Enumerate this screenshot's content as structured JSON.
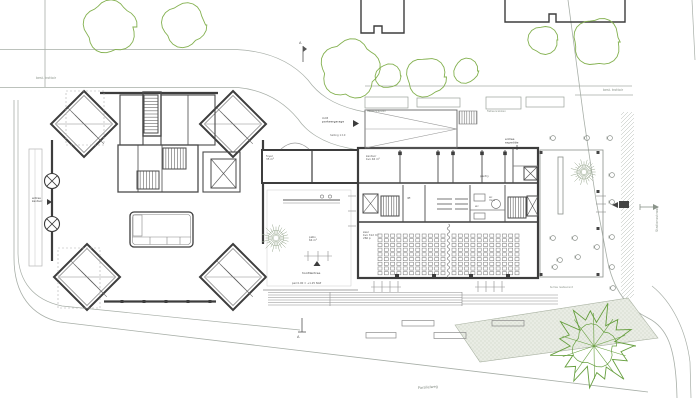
{
  "drawing": {
    "type": "architectural-site-plan-ground-floor",
    "colors": {
      "wall": "#3d3d3d",
      "wall_medium": "#5a5a5a",
      "fine": "#8c8c8c",
      "site_line": "#a7aea7",
      "tree_green": "#84b150",
      "tree_green_dark": "#669f3e",
      "bed_fill": "#e9ece4",
      "bed_dot": "#b9c3b0",
      "seat": "#7d7d7d",
      "label_dark": "#3c3c3c",
      "label_gray": "#8a938a"
    },
    "labels": [
      {
        "id": "note-nw",
        "t": "best. trottoir",
        "x": 36,
        "y": 79,
        "s": 3.2,
        "c": "#8a938a"
      },
      {
        "id": "note-ne",
        "t": "best. trottoir",
        "x": 603,
        "y": 91,
        "s": 3.2,
        "c": "#8a938a"
      },
      {
        "id": "street-east",
        "t": "Stationsstraat",
        "x": 658,
        "y": 232,
        "s": 3.5,
        "c": "#8a938a",
        "rot": -90
      },
      {
        "id": "street-south",
        "t": "Parallelweg",
        "x": 418,
        "y": 389,
        "s": 3.5,
        "c": "#7d867d",
        "rot": -4
      },
      {
        "id": "ramp-entry",
        "t": "inrit\nparkeergarage",
        "x": 322,
        "y": 119,
        "s": 3,
        "c": "#3c3c3c"
      },
      {
        "id": "ramp-slope",
        "t": "helling 1:10",
        "x": 330,
        "y": 136,
        "s": 2.6,
        "c": "#666666"
      },
      {
        "id": "bike-1",
        "t": "fietsenrekken",
        "x": 367,
        "y": 112,
        "s": 2.8,
        "c": "#8a938a"
      },
      {
        "id": "bike-2",
        "t": "fietsenrekken",
        "x": 487,
        "y": 112,
        "s": 2.8,
        "c": "#8a938a"
      },
      {
        "id": "entry-ne",
        "t": "entree\nexpeditie",
        "x": 505,
        "y": 140,
        "s": 2.9,
        "c": "#3c3c3c"
      },
      {
        "id": "room-a",
        "t": "kantoor\nbvo 46 m²",
        "x": 366,
        "y": 157,
        "s": 2.7,
        "c": "#555555"
      },
      {
        "id": "room-b",
        "t": "pantry",
        "x": 480,
        "y": 177,
        "s": 2.7,
        "c": "#555555"
      },
      {
        "id": "room-c",
        "t": "lift",
        "x": 407,
        "y": 199,
        "s": 2.7,
        "c": "#555555"
      },
      {
        "id": "room-d",
        "t": "wc",
        "x": 475,
        "y": 207,
        "s": 2.7,
        "c": "#555555"
      },
      {
        "id": "room-e",
        "t": "wc\nmiva",
        "x": 489,
        "y": 198,
        "s": 2.5,
        "c": "#555555"
      },
      {
        "id": "zaal",
        "t": "zaal\nbvo 312 m²\n260 p",
        "x": 363,
        "y": 233,
        "s": 2.7,
        "c": "#555555"
      },
      {
        "id": "patio",
        "t": "patio\n64 m²",
        "x": 309,
        "y": 238,
        "s": 2.7,
        "c": "#555555"
      },
      {
        "id": "hoofdentree",
        "t": "hoofdentree",
        "x": 302,
        "y": 274,
        "s": 3,
        "c": "#3c3c3c"
      },
      {
        "id": "peil",
        "t": "peil 0.00 = +1.25 NAP",
        "x": 292,
        "y": 284,
        "s": 2.6,
        "c": "#555555"
      },
      {
        "id": "west-entry",
        "t": "entree\nkantoor",
        "x": 32,
        "y": 199,
        "s": 2.7,
        "c": "#3c3c3c"
      },
      {
        "id": "link-room",
        "t": "foyer\n35 m²",
        "x": 266,
        "y": 157,
        "s": 2.7,
        "c": "#555555"
      },
      {
        "id": "terras",
        "t": "terras restaurant",
        "x": 550,
        "y": 288,
        "s": 2.7,
        "c": "#8a938a"
      },
      {
        "id": "marker-top",
        "t": "A",
        "x": 299,
        "y": 44,
        "s": 3.6,
        "c": "#555555"
      },
      {
        "id": "marker-bottom",
        "t": "A",
        "x": 297,
        "y": 338,
        "s": 3.6,
        "c": "#555555"
      }
    ],
    "trees": {
      "outline": [
        [
          110,
          27,
          25
        ],
        [
          184,
          25,
          21
        ],
        [
          350,
          69,
          28
        ],
        [
          388,
          76,
          12
        ],
        [
          426,
          77,
          19
        ],
        [
          466,
          71,
          12
        ],
        [
          543,
          40,
          14
        ],
        [
          597,
          42,
          23
        ]
      ],
      "hatched": [
        [
          276,
          238,
          14
        ],
        [
          584,
          172,
          13
        ]
      ],
      "big": [
        594,
        346,
        44
      ]
    },
    "chairs": [
      [
        553,
        138
      ],
      [
        587,
        138
      ],
      [
        610,
        138
      ],
      [
        612,
        175
      ],
      [
        612,
        202
      ],
      [
        612,
        237
      ],
      [
        612,
        267
      ],
      [
        613,
        288
      ],
      [
        553,
        238
      ],
      [
        575,
        238
      ],
      [
        560,
        260
      ],
      [
        578,
        257
      ],
      [
        555,
        267
      ],
      [
        597,
        247
      ]
    ],
    "benches": [
      [
        402,
        320.5,
        32,
        5.5
      ],
      [
        492,
        320.5,
        32,
        5.5
      ],
      [
        366,
        332.5,
        30,
        5.5
      ],
      [
        434,
        332.5,
        32,
        6
      ]
    ],
    "planters": [
      [
        365,
        97,
        43,
        11
      ],
      [
        417,
        98,
        43,
        9
      ],
      [
        486,
        97,
        35,
        12
      ],
      [
        526,
        97,
        38,
        10
      ]
    ],
    "columns": {
      "top": [
        [
          400,
          151.5
        ],
        [
          438,
          151.5
        ],
        [
          453,
          151.5
        ],
        [
          482,
          151.5
        ],
        [
          505,
          151.5
        ]
      ],
      "bottom": [
        [
          397,
          274
        ],
        [
          434,
          274
        ],
        [
          471,
          274
        ],
        [
          508,
          274
        ]
      ],
      "terrace": [
        [
          541,
          151
        ],
        [
          598,
          151
        ],
        [
          541,
          273
        ],
        [
          598,
          273
        ],
        [
          598,
          190
        ],
        [
          598,
          227
        ]
      ]
    },
    "tower_ticks": [
      [
        122,
        300
      ],
      [
        144,
        300
      ],
      [
        166,
        300
      ],
      [
        188,
        300
      ],
      [
        210,
        300
      ]
    ],
    "auditorium": {
      "rows": 9,
      "cols": 11,
      "px": 6.3,
      "py": 4.7,
      "y0": 234,
      "blocks": [
        378,
        452
      ],
      "w": 4,
      "h": 3.2,
      "divider_x": 448.5
    },
    "stairs": [
      [
        144,
        95,
        14,
        38,
        12,
        "h"
      ],
      [
        163,
        148,
        23,
        21,
        8,
        "v"
      ],
      [
        137,
        171,
        22,
        18,
        7,
        "v"
      ],
      [
        381,
        196,
        18,
        20,
        7,
        "v"
      ],
      [
        508,
        197,
        18,
        21,
        7,
        "v"
      ]
    ],
    "elevators": [
      [
        363,
        194,
        15,
        19
      ],
      [
        527,
        196,
        11,
        20
      ],
      [
        524,
        167,
        13,
        13
      ],
      [
        211,
        159,
        25,
        29
      ]
    ],
    "door_circles": [
      [
        52,
        181,
        7.5
      ],
      [
        52,
        224,
        7.5
      ]
    ],
    "tick_groups": [
      {
        "x": 374,
        "y": 281,
        "n": 4,
        "dx": 8,
        "len": 11,
        "dir": "v",
        "bx": 371,
        "by": 287,
        "bw": 30
      },
      {
        "x": 478,
        "y": 281,
        "n": 4,
        "dx": 8,
        "len": 11,
        "dir": "v",
        "bx": 475,
        "by": 287,
        "bw": 30
      },
      {
        "x": 348,
        "y": 196,
        "n": 3,
        "dy": 15,
        "len": 8,
        "dir": "h"
      },
      {
        "x": 596,
        "y": 196,
        "n": 3,
        "dy": 8,
        "len": 10,
        "dir": "h"
      },
      {
        "x": 308,
        "y": 251,
        "n": 3,
        "dx": 10,
        "len": 10,
        "dir": "v",
        "bx": 304,
        "by": 256,
        "bw": 28
      }
    ],
    "shelves": [
      {
        "x1": 437,
        "x2": 452,
        "ys": [
          199,
          204,
          209
        ]
      },
      {
        "x1": 455,
        "x2": 468,
        "ys": [
          199,
          204,
          209
        ]
      }
    ],
    "steps": {
      "full": {
        "x1": 268,
        "x2": 462,
        "ys": [
          292.5,
          295,
          297.5,
          300,
          302.5,
          305
        ]
      },
      "right": {
        "x1": 462,
        "x2": 558,
        "ys": [
          295,
          298,
          301,
          304
        ]
      }
    },
    "bays": {
      "centers": [
        [
          84,
          124
        ],
        [
          233,
          124
        ],
        [
          87,
          277
        ],
        [
          233,
          277
        ]
      ],
      "half_diag": 33
    }
  }
}
